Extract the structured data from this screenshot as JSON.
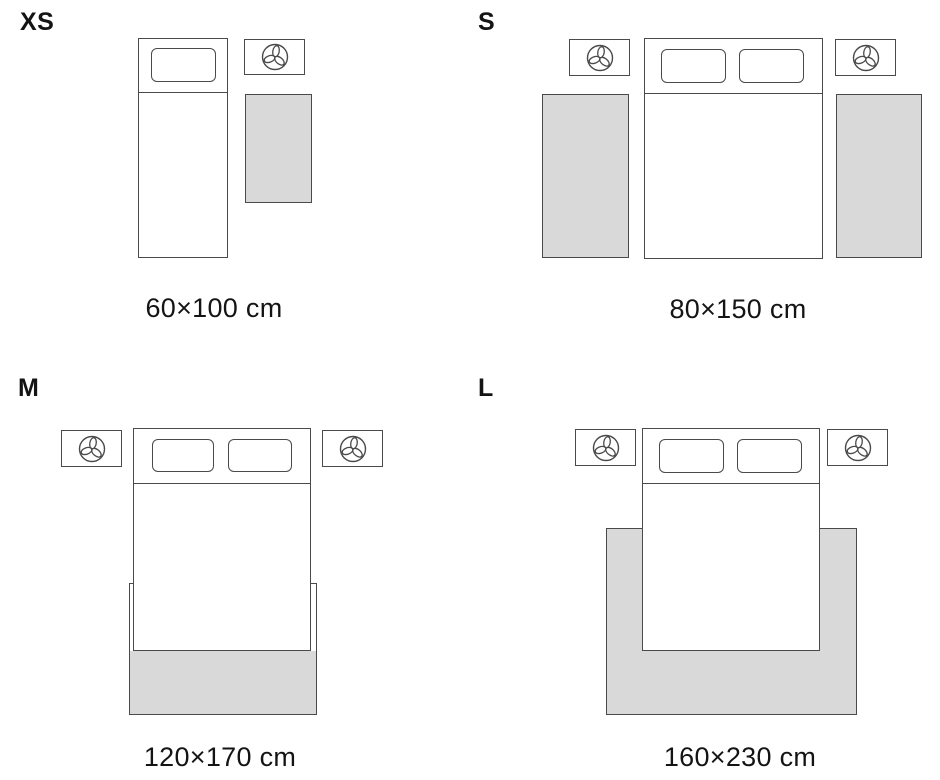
{
  "variants": [
    {
      "id": "xs",
      "label": "XS",
      "dimensions": "60×100 cm"
    },
    {
      "id": "s",
      "label": "S",
      "dimensions": "80×150 cm"
    },
    {
      "id": "m",
      "label": "M",
      "dimensions": "120×170 cm"
    },
    {
      "id": "l",
      "label": "L",
      "dimensions": "160×230 cm"
    }
  ],
  "icons": {
    "nightstand_lamp": "lamp-trefoil-top-view-icon"
  },
  "colors": {
    "background": "#ffffff",
    "line": "#4a4a4a",
    "rug_fill": "#d9d9d9",
    "text": "#141414"
  }
}
